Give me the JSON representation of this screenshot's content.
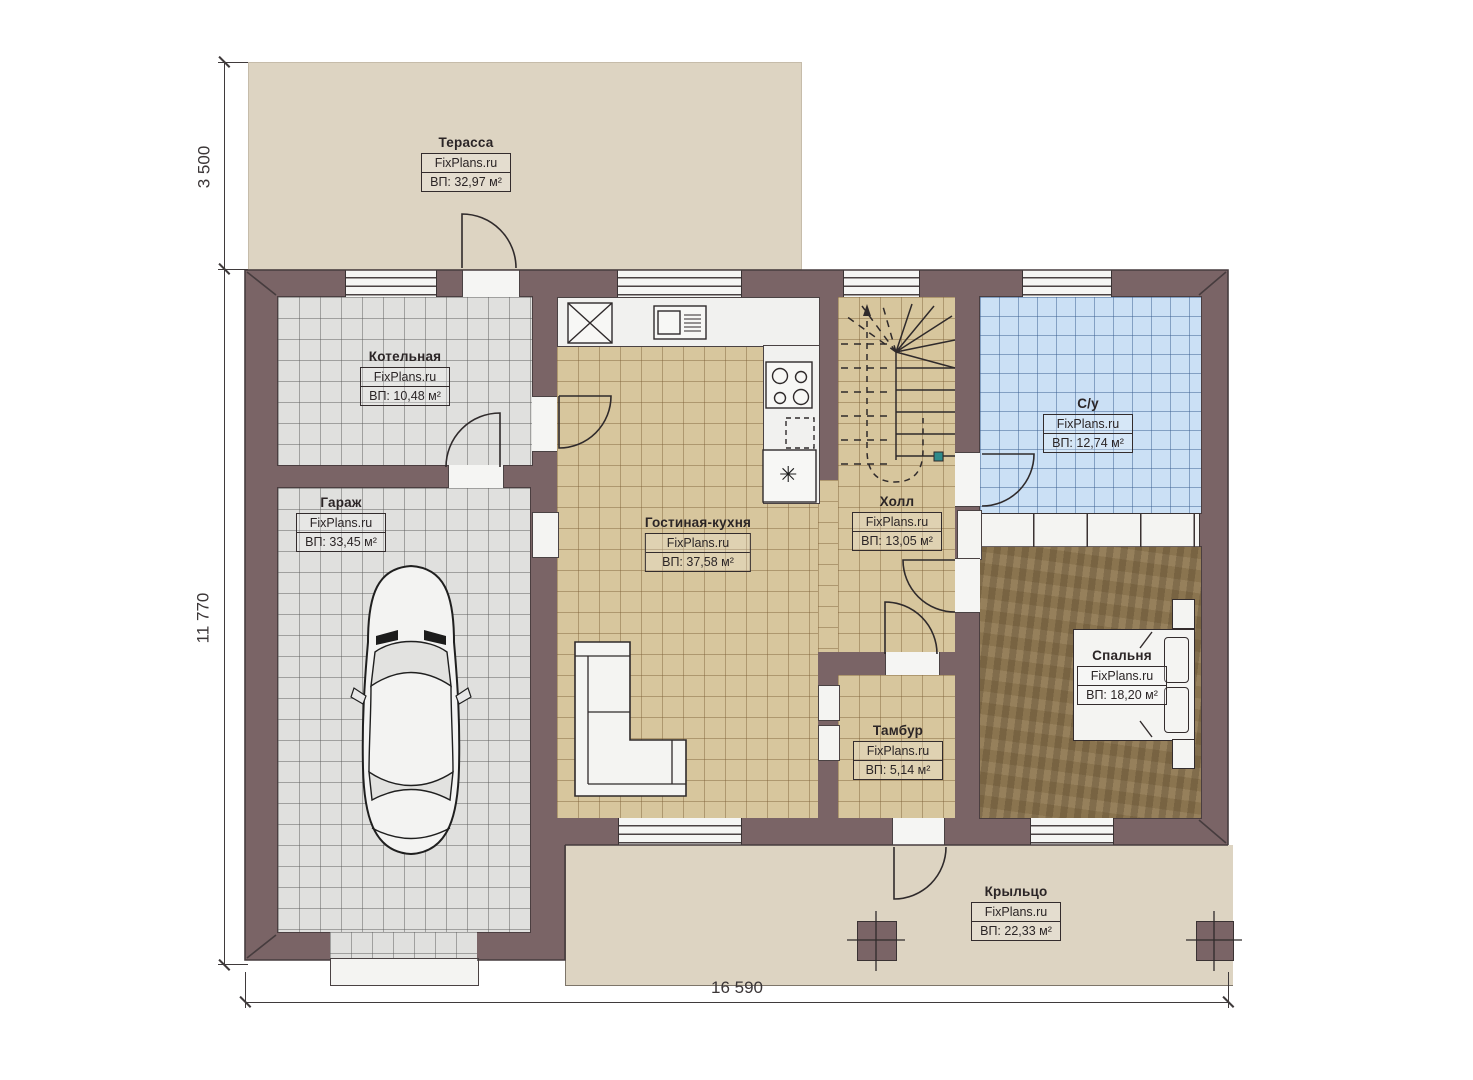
{
  "plan_title": "FixPlans floor plan",
  "brand": "FixPlans.ru",
  "rooms": [
    {
      "key": "terrace",
      "name": "Терасса",
      "brand": "FixPlans.ru",
      "area": "ВП: 32,97 м²"
    },
    {
      "key": "boiler",
      "name": "Котельная",
      "brand": "FixPlans.ru",
      "area": "ВП: 10,48 м²"
    },
    {
      "key": "garage",
      "name": "Гараж",
      "brand": "FixPlans.ru",
      "area": "ВП: 33,45 м²"
    },
    {
      "key": "living-kitchen",
      "name": "Гостиная-кухня",
      "brand": "FixPlans.ru",
      "area": "ВП: 37,58 м²"
    },
    {
      "key": "hall",
      "name": "Холл",
      "brand": "FixPlans.ru",
      "area": "ВП: 13,05 м²"
    },
    {
      "key": "bathroom",
      "name": "С/у",
      "brand": "FixPlans.ru",
      "area": "ВП: 12,74 м²"
    },
    {
      "key": "bedroom",
      "name": "Спальня",
      "brand": "FixPlans.ru",
      "area": "ВП: 18,20 м²"
    },
    {
      "key": "vestibule",
      "name": "Тамбур",
      "brand": "FixPlans.ru",
      "area": "ВП: 5,14 м²"
    },
    {
      "key": "porch",
      "name": "Крыльцо",
      "brand": "FixPlans.ru",
      "area": "ВП: 22,33 м²"
    }
  ],
  "dimensions": {
    "terrace_height": "3 500",
    "house_height": "11 770",
    "house_width": "16 590"
  },
  "icons": {
    "fridge_snowflake": "✳"
  },
  "colors": {
    "wall": "#7a6466",
    "tile_grey": "#e0e0de",
    "tile_tan": "#d7c69d",
    "tile_blue": "#cbe0f5",
    "wood_floor": "#8a744f",
    "outdoor": "#ddd4c2",
    "linework": "#3f3a3b"
  }
}
